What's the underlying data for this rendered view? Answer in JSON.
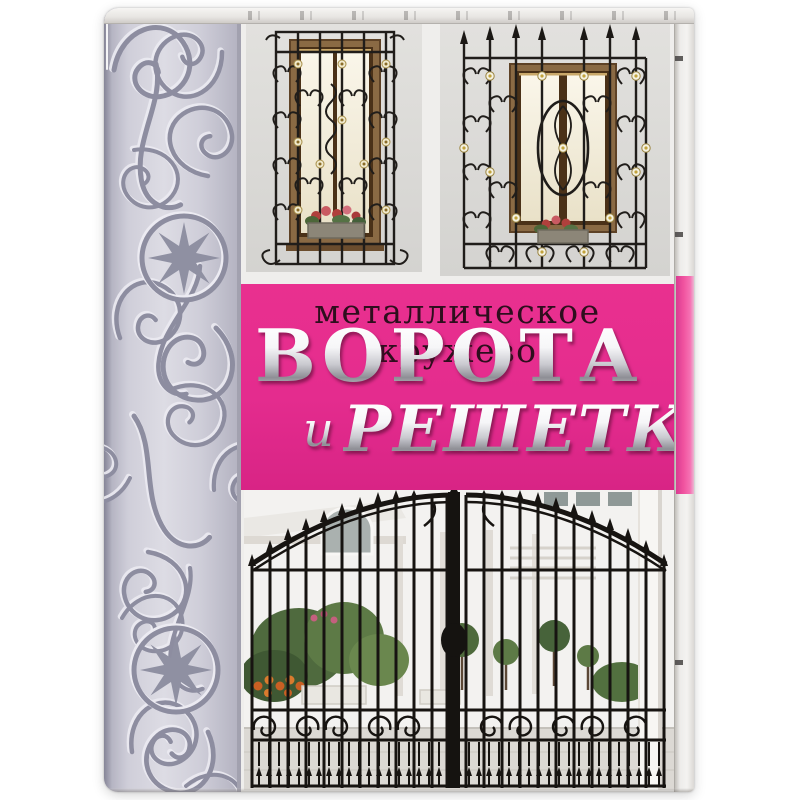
{
  "book_cover": {
    "subtitle": "металлическое кружево",
    "title_word1": "ВОРОТА",
    "title_conj": "и",
    "title_word2": "РЕШЕТКИ",
    "colors": {
      "band_pink": "#e42c8e",
      "fore_edge_pink": "#f0539f",
      "subtitle_text": "#2e0e1d",
      "title_metallic_light": "#ffffff",
      "title_metallic_shade": "#8e8e95",
      "spine_background": "#cfced9",
      "spine_pattern": "#8d8da0",
      "cover_background": "#efeeec",
      "ironwork_black": "#1b1815"
    },
    "photos": {
      "top_left": {
        "label": "window with wrought-iron grille, rosettes and flower box"
      },
      "top_right": {
        "label": "window with wrought-iron grille, spear finials and oval medallion"
      },
      "bottom": {
        "label": "arched black wrought-iron gate in front of white villa with topiary"
      }
    },
    "spine": {
      "label": "embossed silver scrollwork with eight-pointed star medallions"
    }
  }
}
